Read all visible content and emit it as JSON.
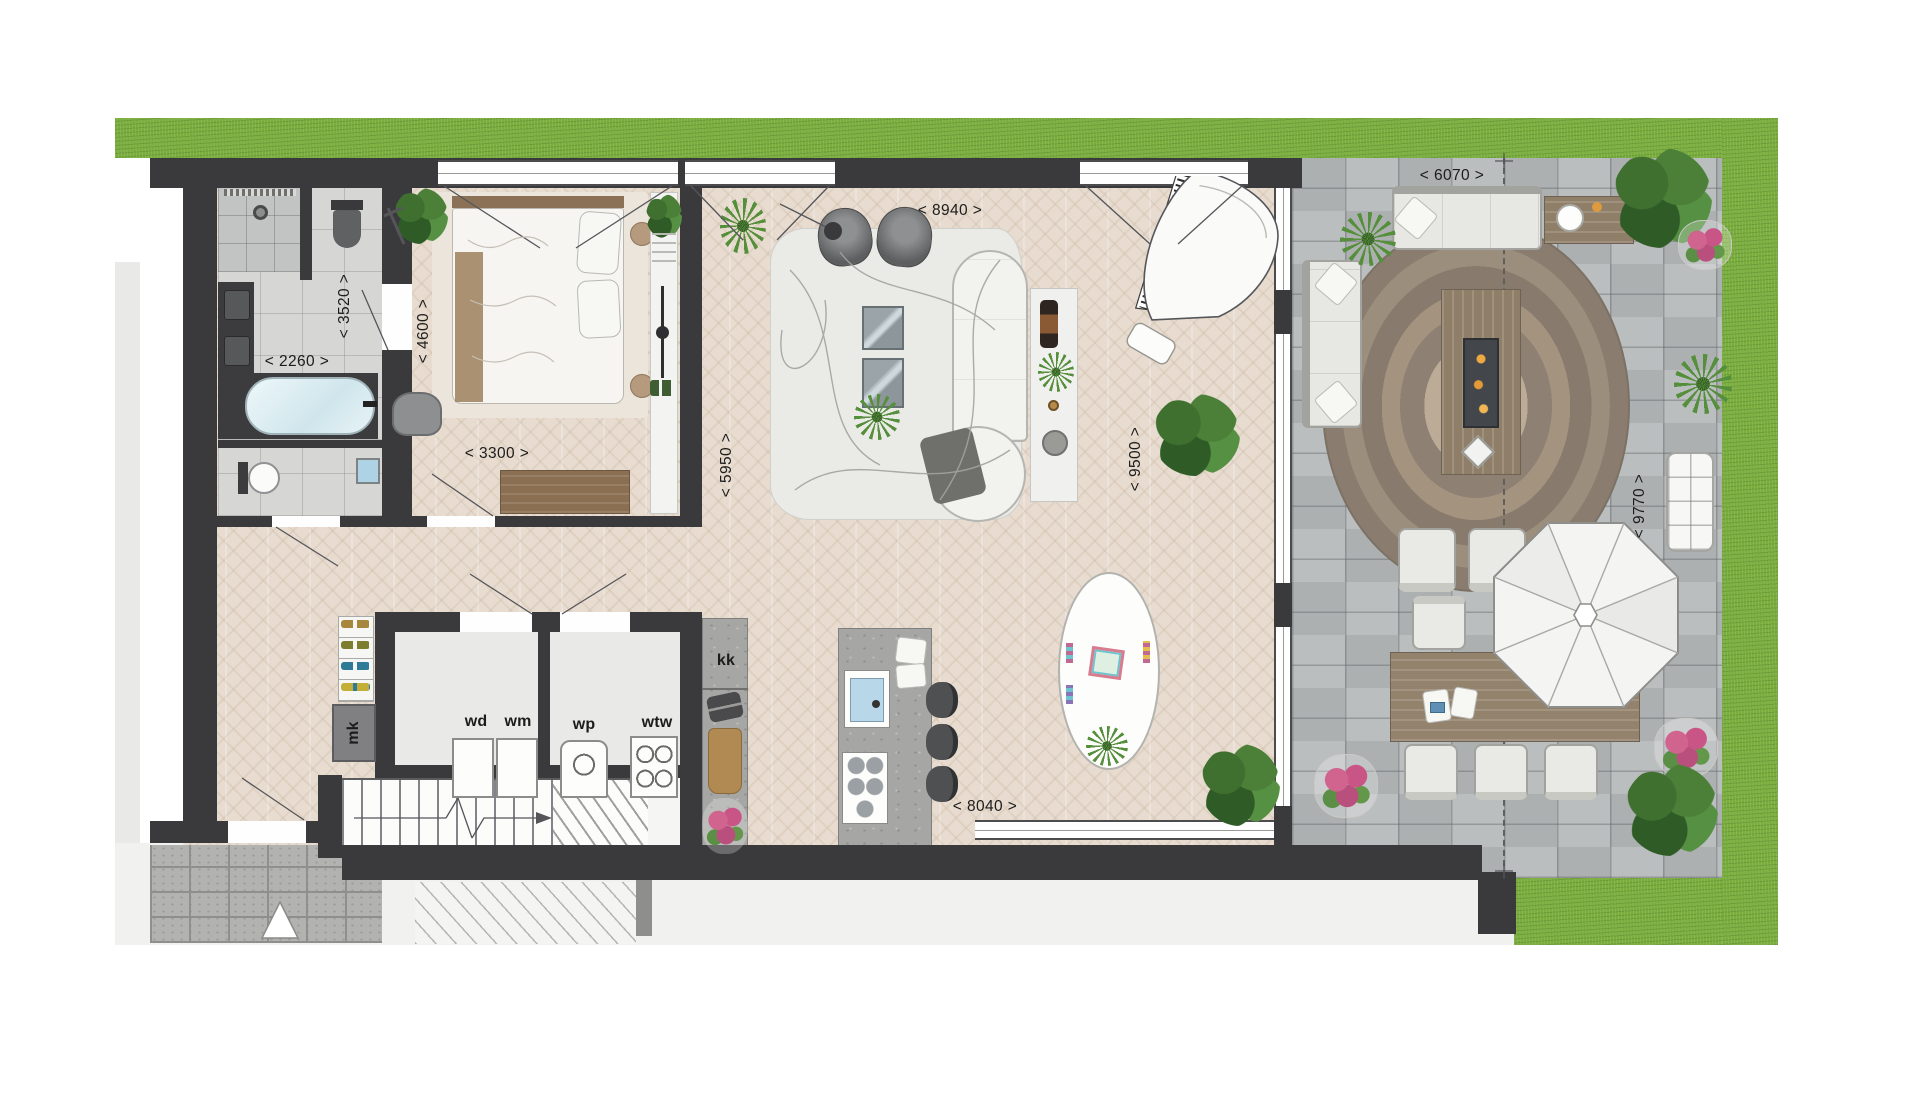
{
  "canvas": {
    "width": 1920,
    "height": 1097,
    "type": "architectural-floor-plan"
  },
  "dimension_labels": [
    {
      "id": "living-width",
      "text": "< 8940 >",
      "orientation": "horizontal"
    },
    {
      "id": "terrace-width",
      "text": "< 6070 >",
      "orientation": "horizontal"
    },
    {
      "id": "bathroom-depth",
      "text": "< 3520 >",
      "orientation": "vertical"
    },
    {
      "id": "bathroom-width",
      "text": "< 2260 >",
      "orientation": "horizontal"
    },
    {
      "id": "bedroom-depth",
      "text": "< 4600 >",
      "orientation": "vertical"
    },
    {
      "id": "bedroom-width",
      "text": "< 3300 >",
      "orientation": "horizontal"
    },
    {
      "id": "living-left-depth",
      "text": "< 5950 >",
      "orientation": "vertical"
    },
    {
      "id": "living-right-depth",
      "text": "< 9500 >",
      "orientation": "vertical"
    },
    {
      "id": "terrace-depth",
      "text": "< 9770 >",
      "orientation": "vertical"
    },
    {
      "id": "sliding-door-width",
      "text": "< 8040 >",
      "orientation": "horizontal"
    }
  ],
  "room_labels": [
    {
      "id": "tall-cabinet",
      "text": "kk"
    },
    {
      "id": "meter-closet",
      "text": "mk"
    },
    {
      "id": "dryer",
      "text": "wd"
    },
    {
      "id": "washing-machine",
      "text": "wm"
    },
    {
      "id": "heat-pump",
      "text": "wp"
    },
    {
      "id": "heat-recovery",
      "text": "wtw"
    }
  ],
  "colors": {
    "wall": "#3a3a3c",
    "grass": "#7aad3e",
    "terrace_pavers": "#b6b9ba",
    "wood_floor": "#e7dccf",
    "bathroom_tile": "#d6d6d4",
    "concrete": "#a6a6a4",
    "plant_green": "#4c8038",
    "flower_pink": "#d1648e"
  }
}
